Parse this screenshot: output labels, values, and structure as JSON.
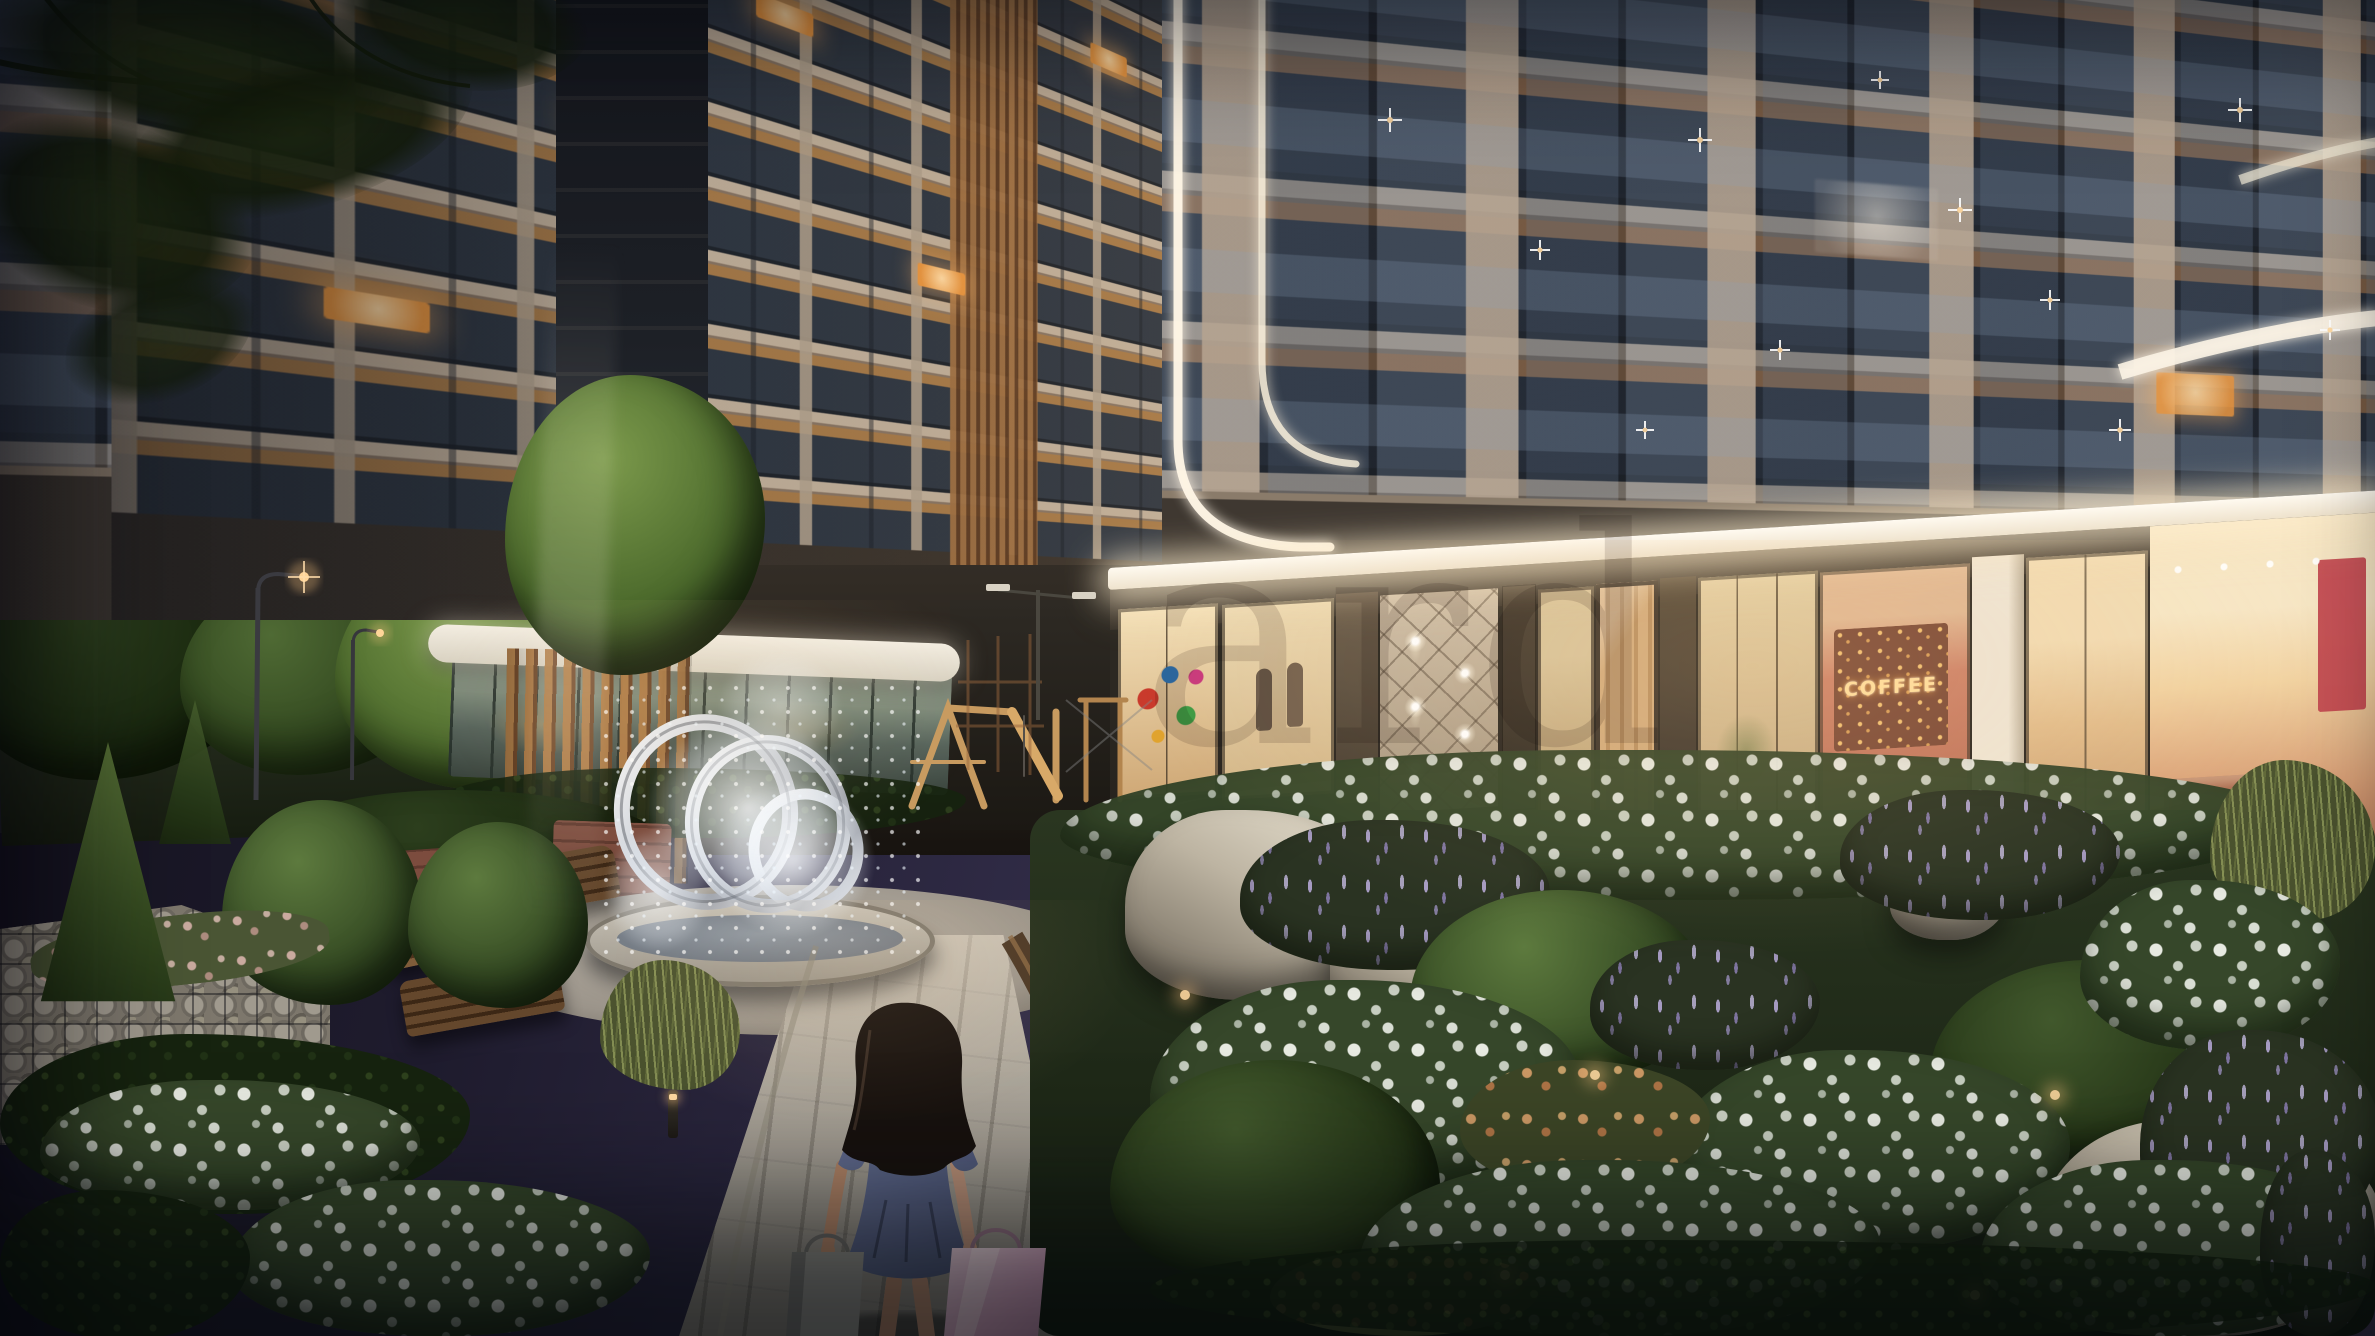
{
  "watermark": {
    "visible_fragment": "ard"
  },
  "signage": {
    "coffee_word_wall": "COFFEE"
  },
  "palette": {
    "sky_top": "#12101b",
    "sky_glow": "#4c4566",
    "star": "#ffffff",
    "facade_slab": "#c9b7a2",
    "facade_pier": "#b0a08d",
    "facade_shadow": "#6e6154",
    "window_glass": "#39414f",
    "window_lit": "#f4bc7d",
    "balcony_soffit": "#ad7c52",
    "led_canopy": "#fdf4e4",
    "storefront_glass": "#ecd7ae",
    "entrance_wall": "#c4b5a0",
    "coffee_wall": "#b96e55",
    "word_wall_glow": "#ffd993",
    "pavement": "#aaa49a",
    "wood_edge": "#4b3526",
    "foliage_dark": "#1c2913",
    "foliage_lit": "#5d7a3e",
    "flower_white": "#edefe6",
    "flower_purple": "#a99cc9",
    "flower_warm": "#cf9a66",
    "rock": "#d3ccbd",
    "gabion_stone": "#8f8a80",
    "fountain_ring": "#e9eaee",
    "water_spray": "#f4f7fa",
    "girl_hair": "#17110e",
    "girl_dress": "#57617f",
    "girl_skin": "#bb9179",
    "bag_gray": "#8e8c86",
    "bag_pink": "#d9a9c4",
    "brick": "#8a5a4b",
    "bench_wood": "#7a5836"
  },
  "scene": {
    "time_of_day": "night",
    "subject": "residential-complex-courtyard",
    "elements": [
      "starry-sky",
      "tree-branch-silhouettes",
      "street-lamps",
      "road",
      "glass-pavilion",
      "high-rise-tower",
      "led-light-strips",
      "illuminated-canopy",
      "storefronts",
      "kids-store-display",
      "mannequin-display",
      "entrance-diamond-wall",
      "wall-sconces",
      "coffee-shop",
      "cafe-interior",
      "ring-fountain",
      "water-spray",
      "playground",
      "benches",
      "gabion-walls",
      "topiary",
      "flower-beds",
      "lavender-spikes",
      "boulders",
      "paved-walkway",
      "bollard-lights",
      "girl-with-shopping-bags"
    ]
  }
}
